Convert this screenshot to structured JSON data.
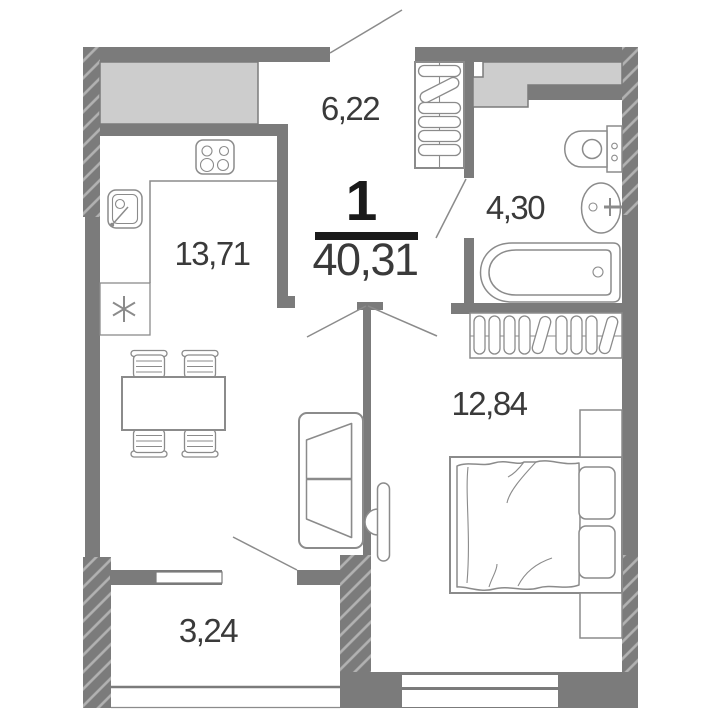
{
  "plan": {
    "unit_number": "1",
    "total_area": "40,31",
    "rooms": [
      {
        "name": "hallway",
        "area": "6,22"
      },
      {
        "name": "kitchen-living-room",
        "area": "13,71"
      },
      {
        "name": "bathroom",
        "area": "4,30"
      },
      {
        "name": "bedroom",
        "area": "12,84"
      },
      {
        "name": "balcony",
        "area": "3,24"
      }
    ],
    "icons": [
      "entrance-door-leaf",
      "hallway-closet-hangers",
      "vent-shaft",
      "toilet",
      "bathroom-sink",
      "bathtub",
      "wardrobe-hangers",
      "double-bed",
      "pillows",
      "nightstands",
      "tv",
      "sofa",
      "dining-table",
      "chairs",
      "stove",
      "kitchen-sink",
      "fridge-snowflake",
      "window",
      "balcony-railing"
    ],
    "colors": {
      "wall": "#7b7b7b",
      "wall_hatch_line": "#b2b2b2",
      "light_fill": "#cdcdcd",
      "furniture_line": "#8b8b8b",
      "label_text": "#3a3a3a",
      "accent_black": "#1a1a1a",
      "background": "#ffffff"
    }
  }
}
